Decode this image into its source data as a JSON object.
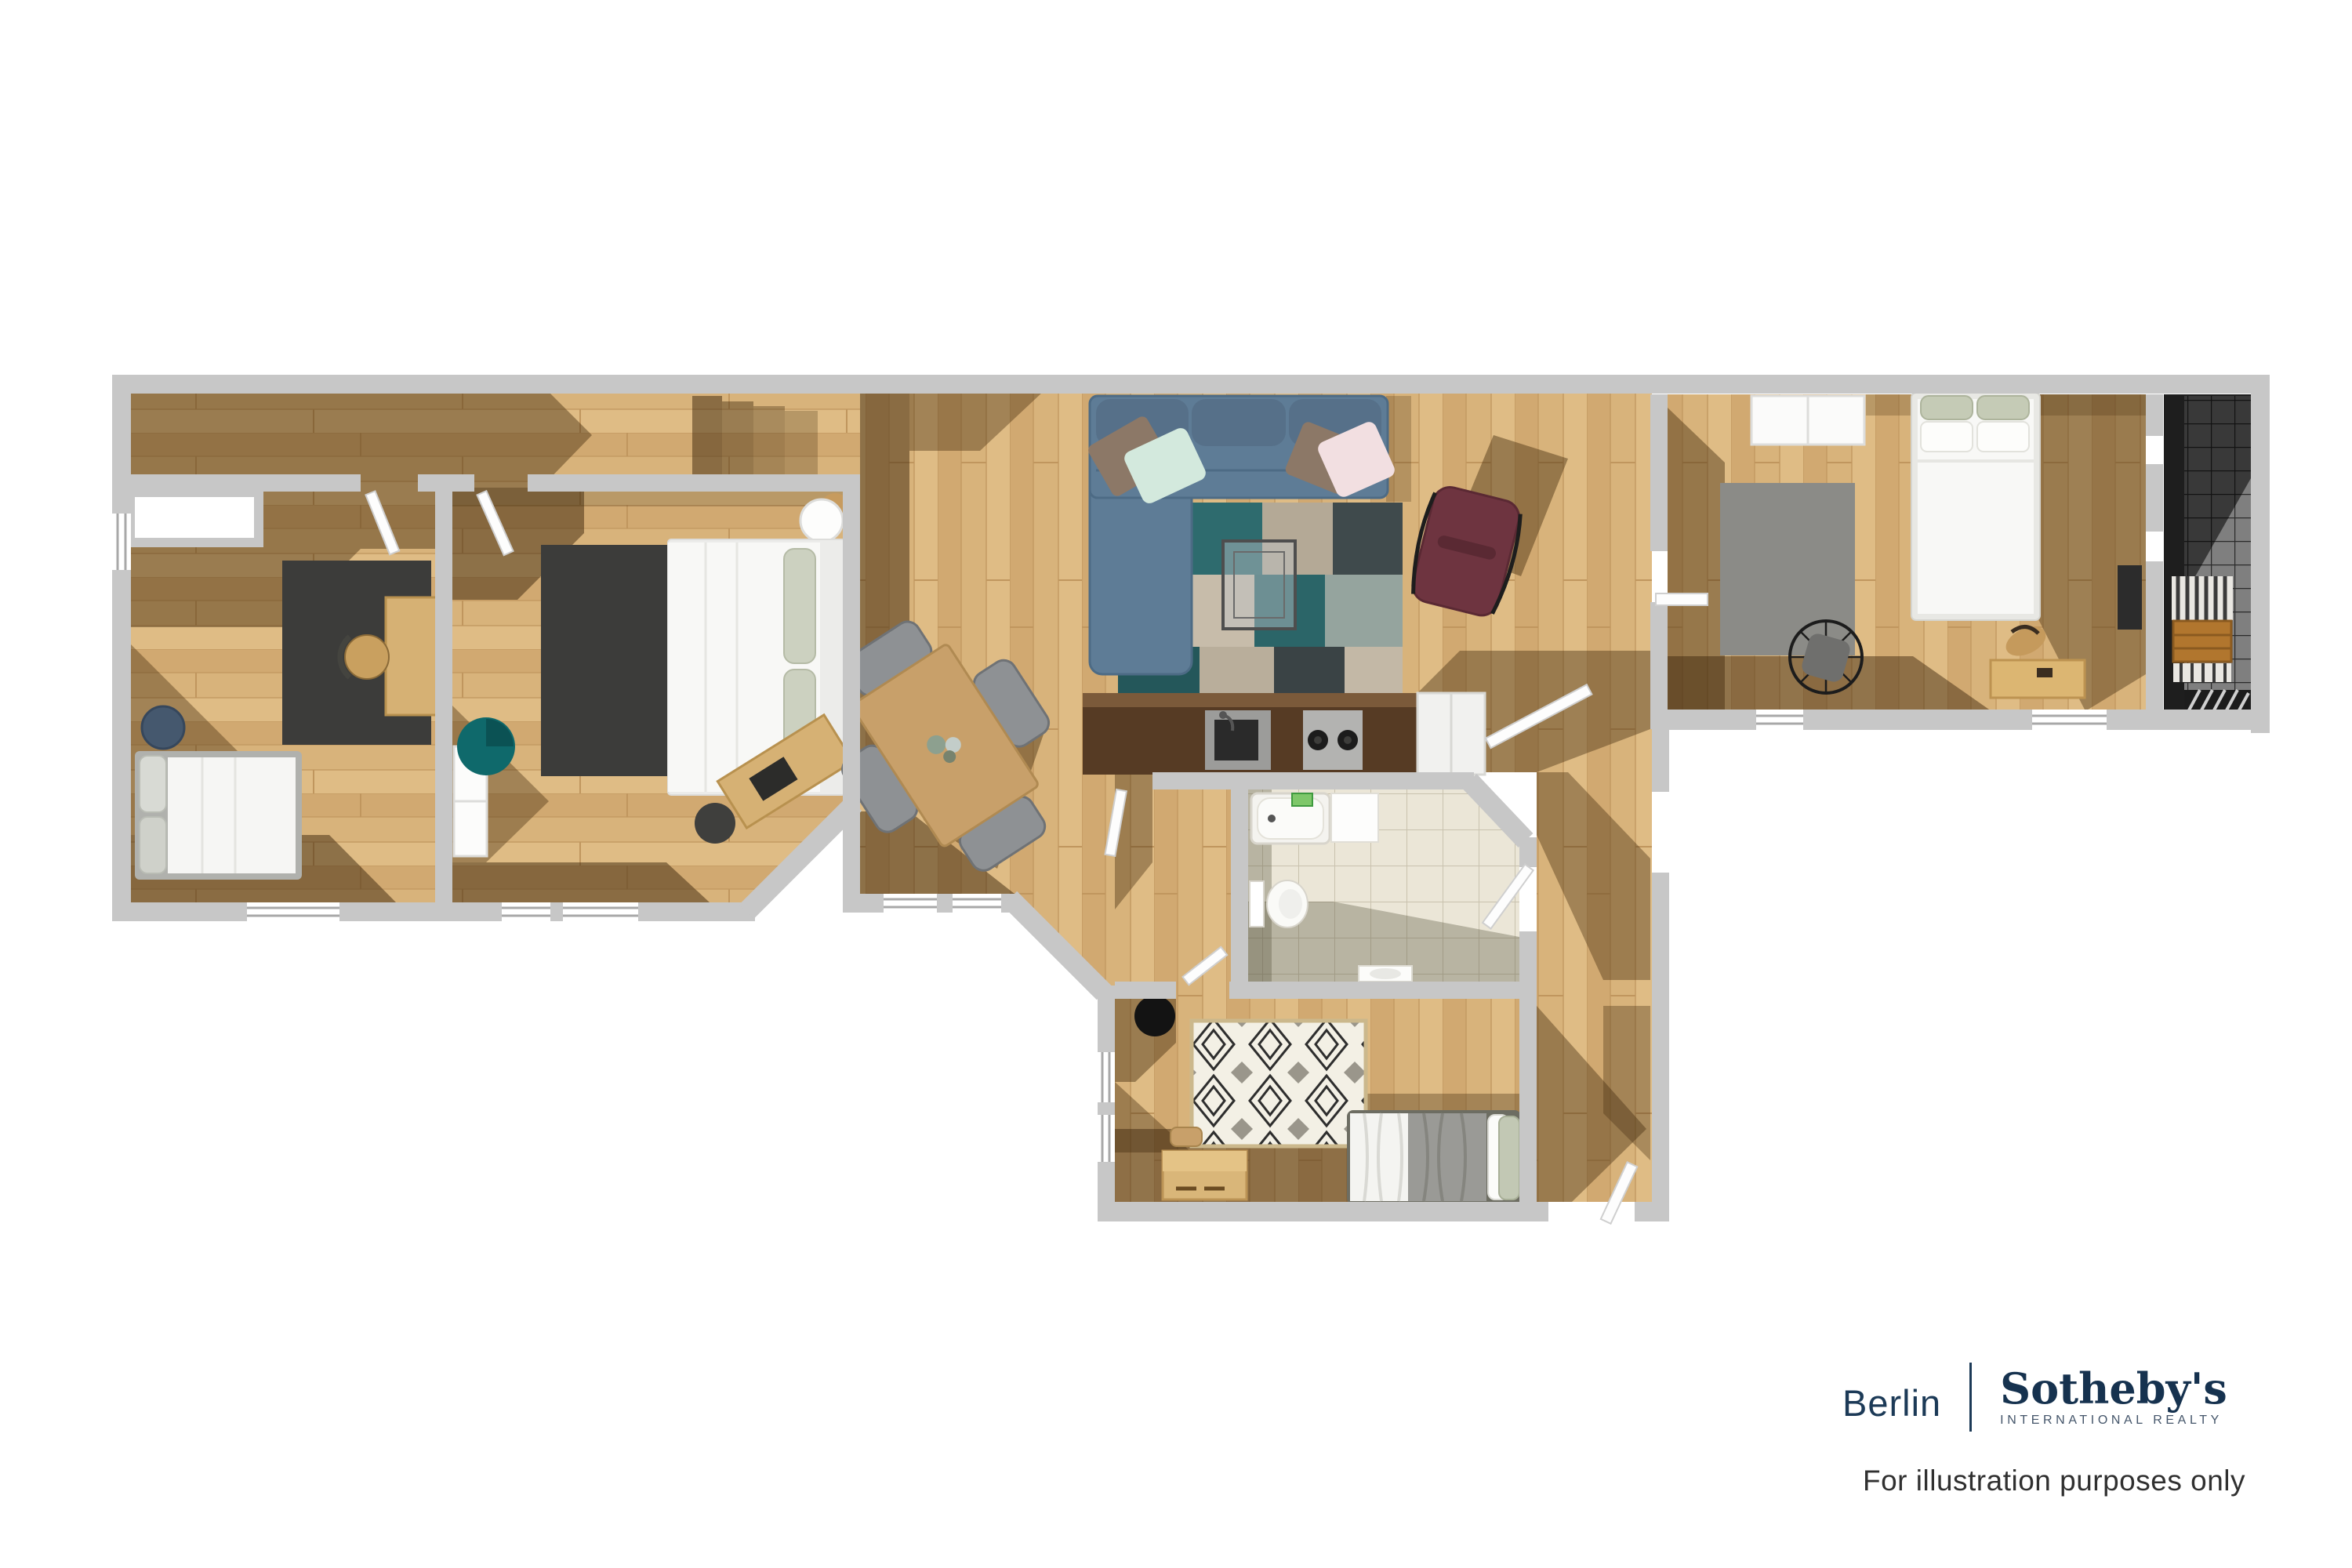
{
  "footer": {
    "office": "Berlin",
    "brand": "Sotheby's",
    "brand_sub": "INTERNATIONAL REALTY",
    "disclaimer": "For illustration purposes only"
  },
  "colors": {
    "wall": "#c7c7c7",
    "floor_wood": "#d8b37b",
    "floor_shadow": "rgba(70,46,16,0.45)",
    "bath_tile": "#ebe6d7",
    "balcony_tile": "#7f7f7f",
    "sofa_blue": "#5e7c96",
    "rug_charcoal": "#3c3c3a",
    "accent_teal": "#0f696b",
    "accent_burgundy": "#6e3440",
    "accent_navy_pouf": "#45586e",
    "brand_navy": "#1c3a57",
    "text_dark": "#303030"
  },
  "floor_plan": {
    "type": "apartment-top-view-3d-floor-plan",
    "rooms": [
      {
        "name": "hallway",
        "furniture": []
      },
      {
        "name": "home-office",
        "furniture": [
          "desk",
          "desk-chair",
          "dark-rug",
          "single-bed",
          "navy-pouf",
          "wall-niche"
        ]
      },
      {
        "name": "bedroom-2",
        "furniture": [
          "double-bed",
          "dark-rug",
          "angled-desk",
          "desk-chair",
          "teal-pouf",
          "wardrobe",
          "round-side-table"
        ]
      },
      {
        "name": "living-dining-room",
        "furniture": [
          "sectional-sofa",
          "sofa-cushions",
          "patchwork-rug",
          "glass-coffee-table",
          "burgundy-lounge-chair",
          "dining-table",
          "dining-chairs"
        ]
      },
      {
        "name": "kitchen",
        "furniture": [
          "counter",
          "sink",
          "two-burner-stove",
          "white-appliance"
        ]
      },
      {
        "name": "bathroom",
        "furniture": [
          "bathtub",
          "toilet",
          "washbasin",
          "shower-panel"
        ]
      },
      {
        "name": "bedroom-3",
        "furniture": [
          "bed",
          "diamond-rug",
          "black-stool",
          "dresser",
          "wood-bench"
        ]
      },
      {
        "name": "master-bedroom",
        "furniture": [
          "double-bed",
          "gray-rug",
          "wire-fan-chair",
          "desk",
          "wardrobe",
          "dark-sideboard"
        ]
      },
      {
        "name": "balcony",
        "furniture": [
          "slatted-shelf",
          "wooden-crates",
          "striped-doormat"
        ]
      },
      {
        "name": "corridor",
        "furniture": []
      }
    ]
  }
}
